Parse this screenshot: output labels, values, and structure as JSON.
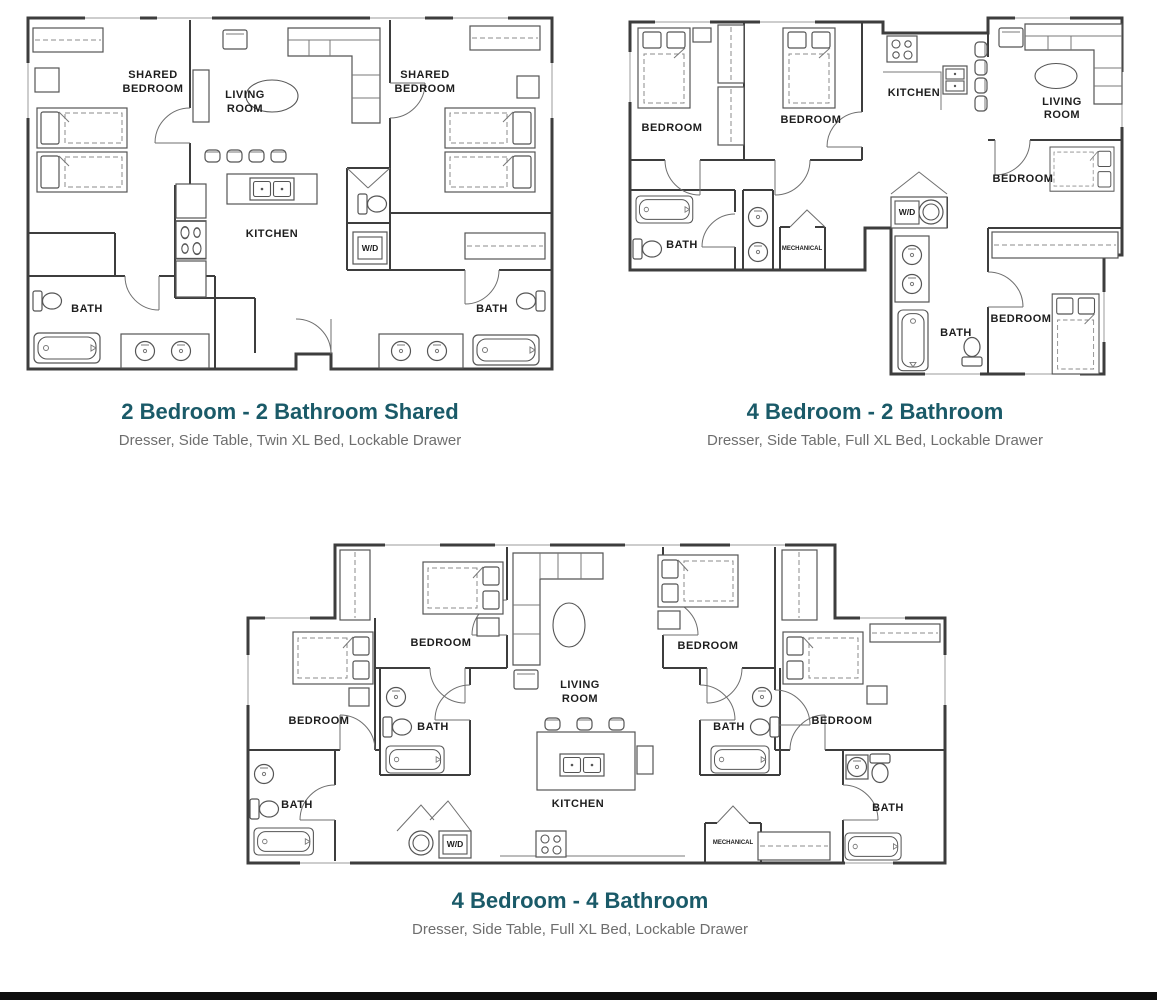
{
  "theme": {
    "accent_color": "#1A5A68",
    "subtitle_color": "#6E6E6E",
    "wall_color": "#3D3D3D",
    "furniture_color": "#555555",
    "label_color": "#1D1D1D",
    "footer_bar_color": "#0E0E0E",
    "background_color": "#FFFFFF"
  },
  "plans": [
    {
      "title": "2 Bedroom - 2 Bathroom Shared",
      "subtitle": "Dresser, Side Table, Twin XL Bed, Lockable Drawer",
      "labels": {
        "shared_bedroom_left": [
          "SHARED",
          "BEDROOM"
        ],
        "living_room": [
          "LIVING",
          "ROOM"
        ],
        "shared_bedroom_right": [
          "SHARED",
          "BEDROOM"
        ],
        "kitchen": "KITCHEN",
        "washer_dryer": "W/D",
        "bath_left": "BATH",
        "bath_right": "BATH"
      }
    },
    {
      "title": "4 Bedroom - 2 Bathroom",
      "subtitle": "Dresser, Side Table, Full XL Bed, Lockable Drawer",
      "labels": {
        "bedroom_1": "BEDROOM",
        "bedroom_2": "BEDROOM",
        "kitchen": "KITCHEN",
        "living_room": [
          "LIVING",
          "ROOM"
        ],
        "bedroom_3": "BEDROOM",
        "bedroom_4": "BEDROOM",
        "bath_1": "BATH",
        "bath_2": "BATH",
        "washer_dryer": "W/D",
        "mechanical": "MECHANICAL"
      }
    },
    {
      "title": "4 Bedroom - 4 Bathroom",
      "subtitle": "Dresser, Side Table, Full XL Bed, Lockable Drawer",
      "labels": {
        "bedroom_1": "BEDROOM",
        "bedroom_2": "BEDROOM",
        "bedroom_3": "BEDROOM",
        "bedroom_4": "BEDROOM",
        "living_room": [
          "LIVING",
          "ROOM"
        ],
        "kitchen": "KITCHEN",
        "bath_1": "BATH",
        "bath_2": "BATH",
        "bath_3": "BATH",
        "bath_4": "BATH",
        "washer_dryer": "W/D",
        "mechanical": "MECHANICAL"
      }
    }
  ]
}
